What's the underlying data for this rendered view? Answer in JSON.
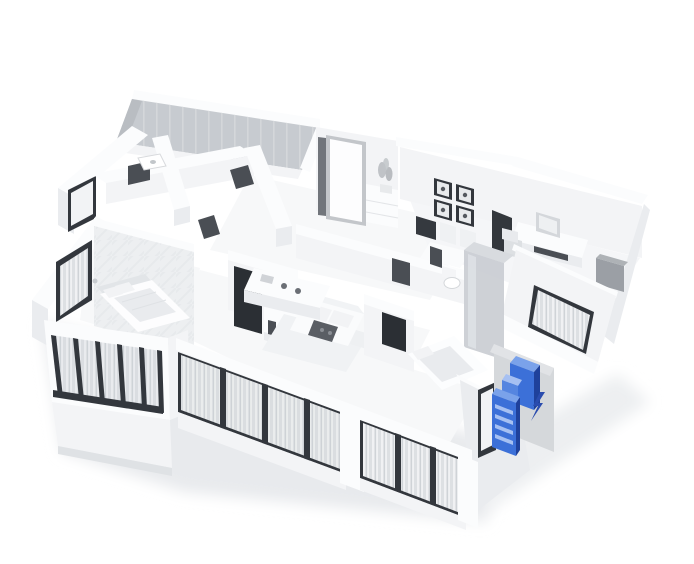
{
  "scene": {
    "kind": "3d-apartment-floorplan-render",
    "background": "#ffffff",
    "rooms": [
      {
        "name": "balcony"
      },
      {
        "name": "bedroom-left"
      },
      {
        "name": "bathroom-top-left"
      },
      {
        "name": "entry-hall"
      },
      {
        "name": "kitchen-dining"
      },
      {
        "name": "living-room"
      },
      {
        "name": "study"
      },
      {
        "name": "bathroom-right"
      },
      {
        "name": "shower-room"
      },
      {
        "name": "bedroom-bottom"
      }
    ],
    "palette": {
      "glass": "#c7cbd0",
      "glass_top": "#d8dbdf",
      "frosted_glass": "#edeff1",
      "frame_dark": "#33373d",
      "tv_screen": "#2b2f34",
      "pad_gray": "#d5d8db",
      "pad_gray_light": "#e1e3e6",
      "shadow": "#e8eaed",
      "shadow_soft": "#edeff1"
    },
    "highlight": {
      "item": "cabinet-unit-selected",
      "front": "#3c70d8",
      "side": "#1f419b",
      "top": "#7aa2ea",
      "mid": "#5585e0",
      "stripe": "#a6c0f2",
      "cursor": "#2a4cae"
    }
  }
}
